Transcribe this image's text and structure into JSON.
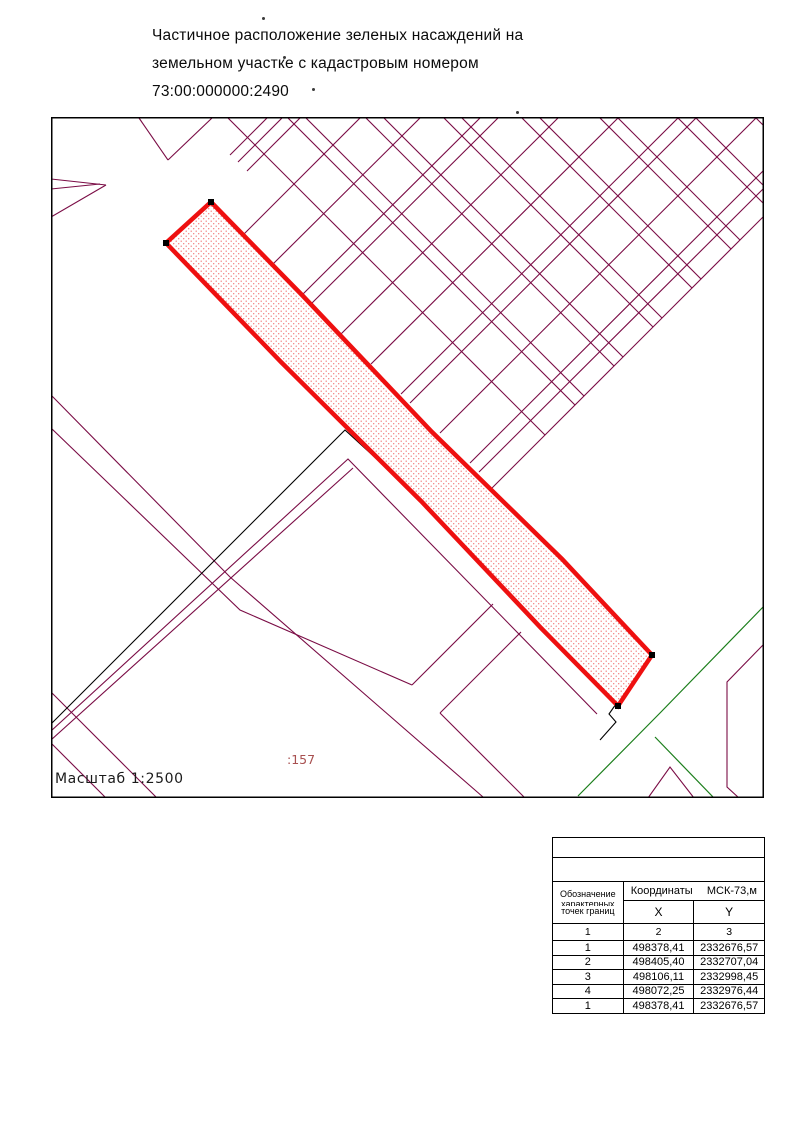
{
  "title": {
    "line1": "Частичное  расположение зеленых насаждений на",
    "line2": "земельном участке с кадастровым номером",
    "line3": "73:00:000000:2490"
  },
  "artifacts": [
    {
      "x": 262,
      "y": 17
    },
    {
      "x": 283,
      "y": 56
    },
    {
      "x": 312,
      "y": 88
    },
    {
      "x": 516,
      "y": 111
    }
  ],
  "map": {
    "frame": {
      "x": 51,
      "y": 117,
      "width": 713,
      "height": 681
    },
    "scale_label": "Масштаб 1:2500",
    "parcel_label": ":157",
    "colors": {
      "cadastral": "#7a0c45",
      "parcel_border": "#ee1010",
      "parcel_dot": "#f27d7d",
      "green": "#1b7e1b",
      "black": "#000000",
      "parcel_label": "#a85050",
      "frame": "#000000"
    },
    "parcel": {
      "outline": [
        [
          211,
          202
        ],
        [
          302,
          295
        ],
        [
          432,
          432
        ],
        [
          562,
          559
        ],
        [
          652,
          655
        ],
        [
          618,
          706
        ],
        [
          541,
          628
        ],
        [
          421,
          501
        ],
        [
          281,
          362
        ],
        [
          166,
          243
        ]
      ],
      "markers": [
        [
          211,
          202
        ],
        [
          166,
          243
        ],
        [
          652,
          655
        ],
        [
          618,
          706
        ]
      ]
    },
    "maroon_segments": [
      [
        227,
        117,
        545,
        435
      ],
      [
        287,
        117,
        575,
        405
      ],
      [
        305,
        117,
        584,
        396
      ],
      [
        365,
        117,
        614,
        366
      ],
      [
        383,
        117,
        623,
        357
      ],
      [
        443,
        117,
        653,
        327
      ],
      [
        461,
        117,
        662,
        318
      ],
      [
        521,
        117,
        692,
        288
      ],
      [
        539,
        117,
        701,
        279
      ],
      [
        599,
        117,
        731,
        249
      ],
      [
        617,
        117,
        740,
        240
      ],
      [
        677,
        117,
        764,
        204
      ],
      [
        695,
        117,
        764,
        186
      ],
      [
        755,
        117,
        764,
        126
      ],
      [
        283,
        117,
        238,
        162
      ],
      [
        301,
        117,
        247,
        171
      ],
      [
        361,
        117,
        243,
        235
      ],
      [
        421,
        117,
        272,
        265
      ],
      [
        481,
        117,
        302,
        295
      ],
      [
        499,
        117,
        311,
        304
      ],
      [
        559,
        117,
        341,
        334
      ],
      [
        619,
        117,
        371,
        364
      ],
      [
        679,
        117,
        401,
        394
      ],
      [
        697,
        117,
        410,
        403
      ],
      [
        757,
        117,
        440,
        433
      ],
      [
        764,
        170,
        470,
        463
      ],
      [
        764,
        188,
        479,
        472
      ],
      [
        764,
        216,
        488,
        492
      ],
      [
        139,
        118,
        168,
        160
      ],
      [
        168,
        160,
        212,
        118
      ],
      [
        230,
        155,
        267,
        118
      ],
      [
        51,
        179,
        106,
        185
      ],
      [
        106,
        185,
        51,
        217
      ],
      [
        51,
        189,
        100,
        184
      ],
      [
        51,
        692,
        157,
        798
      ],
      [
        51,
        743,
        106,
        798
      ],
      [
        412,
        685,
        493,
        604
      ],
      [
        440,
        713,
        521,
        632
      ],
      [
        440,
        713,
        525,
        798
      ]
    ],
    "maroon_polylines": [
      [
        [
          51,
          395
        ],
        [
          230,
          577
        ],
        [
          483,
          797
        ]
      ],
      [
        [
          51,
          428
        ],
        [
          240,
          610
        ],
        [
          412,
          685
        ]
      ],
      [
        [
          51,
          731
        ],
        [
          348,
          459
        ],
        [
          597,
          714
        ]
      ],
      [
        [
          51,
          740
        ],
        [
          353,
          468
        ]
      ],
      [
        [
          763,
          645
        ],
        [
          727,
          682
        ],
        [
          727,
          787
        ],
        [
          739,
          798
        ]
      ],
      [
        [
          648,
          798
        ],
        [
          670,
          767
        ],
        [
          694,
          798
        ]
      ]
    ],
    "black_polylines": [
      [
        [
          51,
          724
        ],
        [
          345,
          430
        ],
        [
          427,
          505
        ],
        [
          546,
          631
        ],
        [
          616,
          704
        ],
        [
          609,
          714
        ],
        [
          616,
          722
        ],
        [
          600,
          740
        ]
      ]
    ],
    "green_polylines": [
      [
        [
          765,
          605
        ],
        [
          660,
          713
        ],
        [
          578,
          796
        ]
      ],
      [
        [
          655,
          737
        ],
        [
          714,
          798
        ]
      ]
    ]
  },
  "table": {
    "header": {
      "designation": [
        "Обозначение",
        "характерных",
        "точек границ"
      ],
      "coords_title": "Координаты",
      "coords_system": "МСК-73,м",
      "col_x": "X",
      "col_y": "Y",
      "index_cols": [
        "1",
        "2",
        "3"
      ]
    },
    "rows": [
      [
        "1",
        "498378,41",
        "2332676,57"
      ],
      [
        "2",
        "498405,40",
        "2332707,04"
      ],
      [
        "3",
        "498106,11",
        "2332998,45"
      ],
      [
        "4",
        "498072,25",
        "2332976,44"
      ],
      [
        "1",
        "498378,41",
        "2332676,57"
      ]
    ]
  }
}
